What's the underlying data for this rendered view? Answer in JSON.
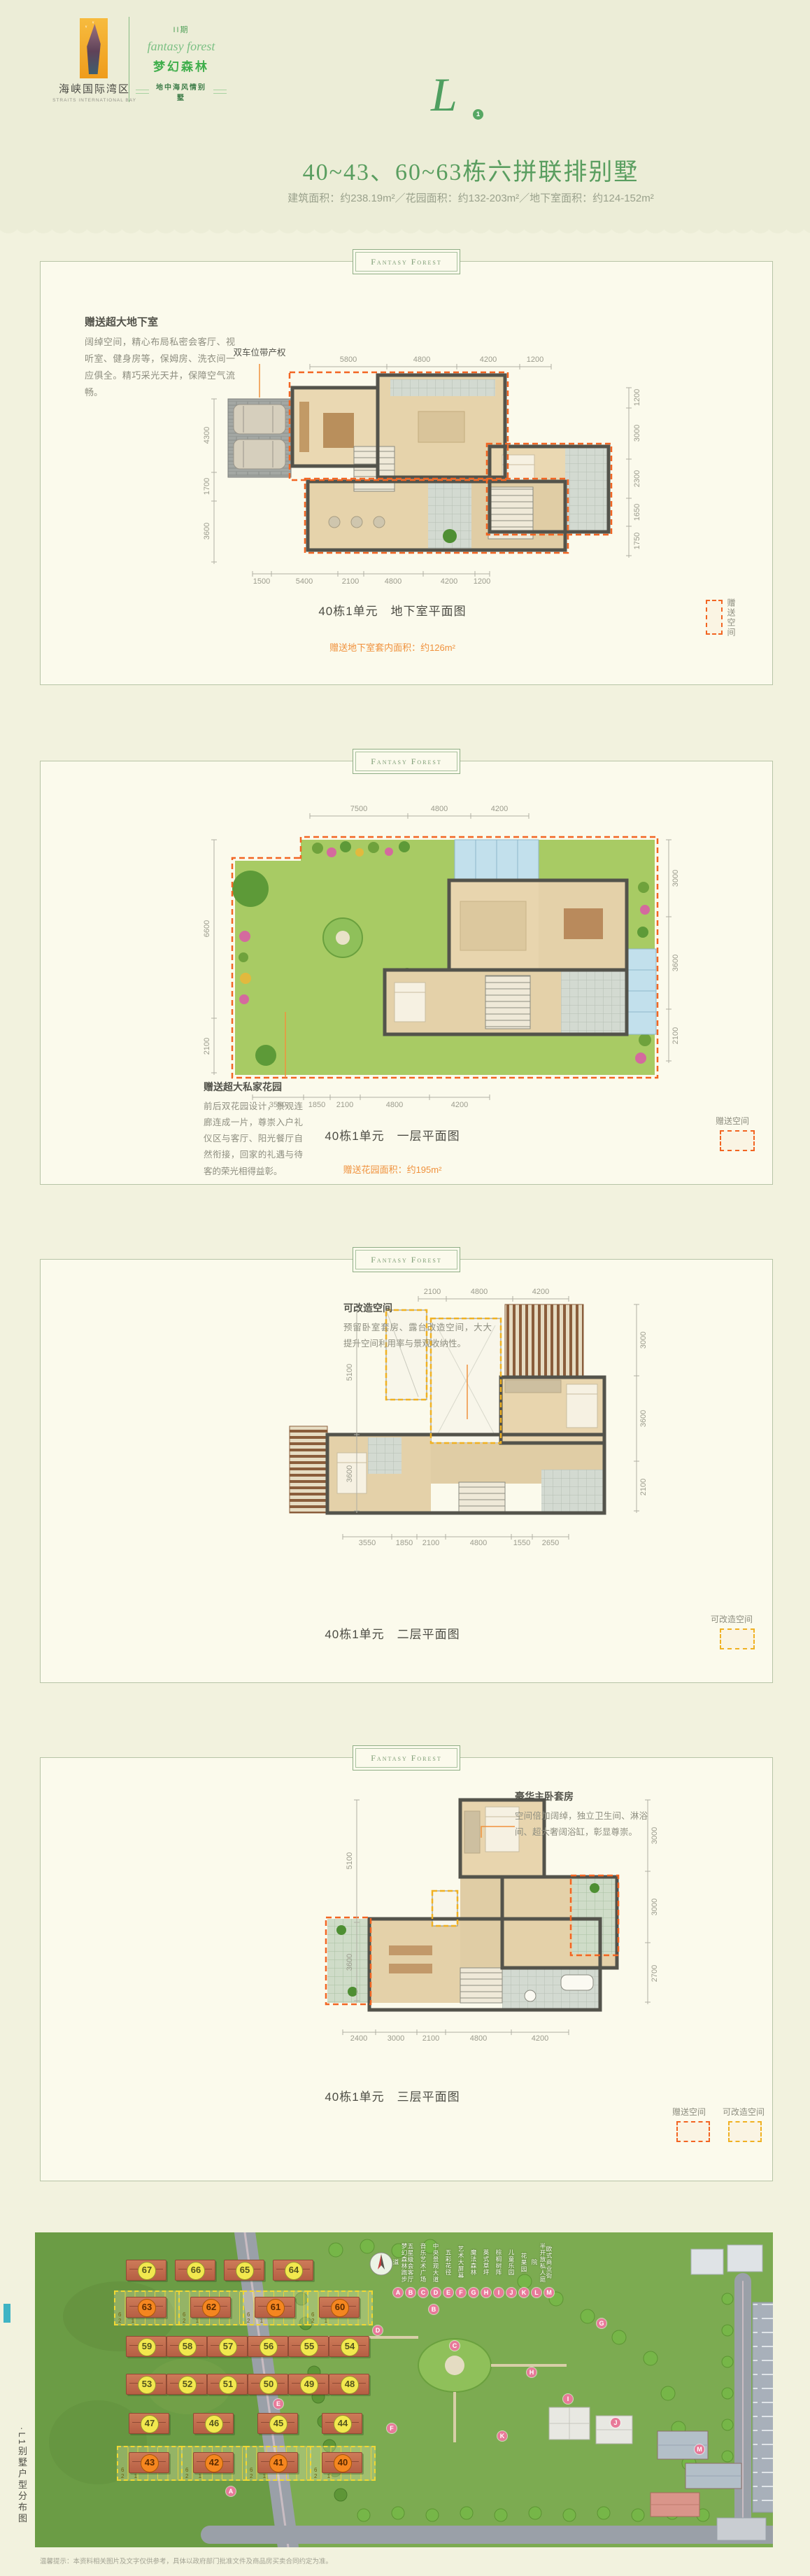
{
  "header": {
    "phase": "II期",
    "script_title": "fantasy forest",
    "subbrand": "梦幻森林",
    "tagline": "地中海风情别墅",
    "logo_cn": "海峡国际湾区",
    "logo_en": "STRAITS INTERNATIONAL BAY",
    "unit_letter": "L",
    "unit_number": "1",
    "title": "40~43、60~63栋六拼联排别墅",
    "subtitle": "建筑面积：约238.19m²／花园面积：约132-203m²／地下室面积：约124-152m²"
  },
  "panel_tag": "Fantasy Forest",
  "colors": {
    "gift": "#f26522",
    "convertible": "#f0b123",
    "accent_green": "#5a9e60"
  },
  "panels": [
    {
      "note_title": "赠送超大地下室",
      "note_body": "阔绰空间，精心布局私密会客厅、视听室、健身房等，保姆房、洗衣间一应俱全。精巧采光天井，保障空气流畅。",
      "callout": "双车位带产权",
      "caption": "40栋1单元　地下室平面图",
      "area_note": "赠送地下室套内面积：约126m²",
      "legend": [
        {
          "label": "赠送空间"
        }
      ],
      "dims": {
        "top": [
          "5800",
          "4800",
          "4200",
          "1200"
        ],
        "left": [
          "4300",
          "1700",
          "3600"
        ],
        "right": [
          "1200",
          "3000",
          "2300",
          "1650",
          "1750"
        ],
        "bottom": [
          "1500",
          "5400",
          "2100",
          "4800",
          "4200",
          "1200"
        ]
      }
    },
    {
      "note_title": "赠送超大私家花园",
      "note_body": "前后双花园设计，景观连廊连成一片，尊崇入户礼仪区与客厅、阳光餐厅自然衔接，回家的礼遇与待客的荣光相得益彰。",
      "caption": "40栋1单元　一层平面图",
      "area_note": "赠送花园面积：约195m²",
      "legend": [
        {
          "label": "赠送空间"
        }
      ],
      "dims": {
        "top": [
          "7500",
          "4800",
          "4200"
        ],
        "left": [
          "6600",
          "2100"
        ],
        "right": [
          "3000",
          "3600",
          "2100"
        ],
        "bottom": [
          "3550",
          "1850",
          "2100",
          "4800",
          "4200"
        ]
      }
    },
    {
      "note_title": "可改造空间",
      "note_body": "预留卧室套房、露台改造空间，大大提升空间利用率与景观收纳性。",
      "caption": "40栋1单元　二层平面图",
      "legend": [
        {
          "label": "可改造空间"
        }
      ],
      "dims": {
        "top": [
          "2100",
          "4800",
          "4200"
        ],
        "left": [
          "5100",
          "3600"
        ],
        "right": [
          "3000",
          "3600",
          "2100"
        ],
        "bottom": [
          "3550",
          "1850",
          "2100",
          "4800",
          "1550",
          "2650"
        ]
      }
    },
    {
      "note_title": "豪华主卧套房",
      "note_body": "空间倍加阔绰，独立卫生间、淋浴间、超大奢阔浴缸，彰显尊崇。",
      "caption": "40栋1单元　三层平面图",
      "legend": [
        {
          "label": "赠送空间"
        },
        {
          "label": "可改造空间"
        }
      ],
      "dims": {
        "top": [],
        "left": [
          "5100",
          "3600"
        ],
        "right": [
          "3000",
          "3000",
          "2700"
        ],
        "bottom": [
          "2400",
          "3000",
          "2100",
          "4800",
          "4200"
        ]
      }
    }
  ],
  "site_map": {
    "side_caption": "·L1别墅户型分布图",
    "unit_digits": "6 5 4 3 2 1",
    "legend": [
      {
        "letter": "A",
        "label": "梦幻森林跑步道"
      },
      {
        "letter": "B",
        "label": "五星级会客厅"
      },
      {
        "letter": "C",
        "label": "音乐艺术广场"
      },
      {
        "letter": "D",
        "label": "中央景观大道"
      },
      {
        "letter": "E",
        "label": "五彩花径"
      },
      {
        "letter": "F",
        "label": "艺术大屏幕"
      },
      {
        "letter": "G",
        "label": "魔法森林"
      },
      {
        "letter": "H",
        "label": "英式草坪"
      },
      {
        "letter": "I",
        "label": "棕榈树阵"
      },
      {
        "letter": "J",
        "label": "儿童乐园"
      },
      {
        "letter": "K",
        "label": "花果园"
      },
      {
        "letter": "L",
        "label": "半开放私人庭院"
      },
      {
        "letter": "M",
        "label": "欧式商业街"
      }
    ],
    "rows": [
      {
        "items": [
          "67",
          "66",
          "65",
          "64"
        ]
      },
      {
        "items": [
          "63",
          "62",
          "61",
          "60"
        ]
      },
      {
        "items": [
          "59",
          "58",
          "57",
          "56",
          "55",
          "54"
        ]
      },
      {
        "items": [
          "53",
          "52",
          "51",
          "50",
          "49",
          "48"
        ]
      },
      {
        "items": [
          "47",
          "46",
          "45",
          "44"
        ]
      },
      {
        "items": [
          "43",
          "42",
          "41",
          "40"
        ]
      }
    ]
  },
  "footer_note": "温馨提示：本资料相关图片及文字仅供参考，具体以政府部门批准文件及商品房买卖合同约定为准。"
}
